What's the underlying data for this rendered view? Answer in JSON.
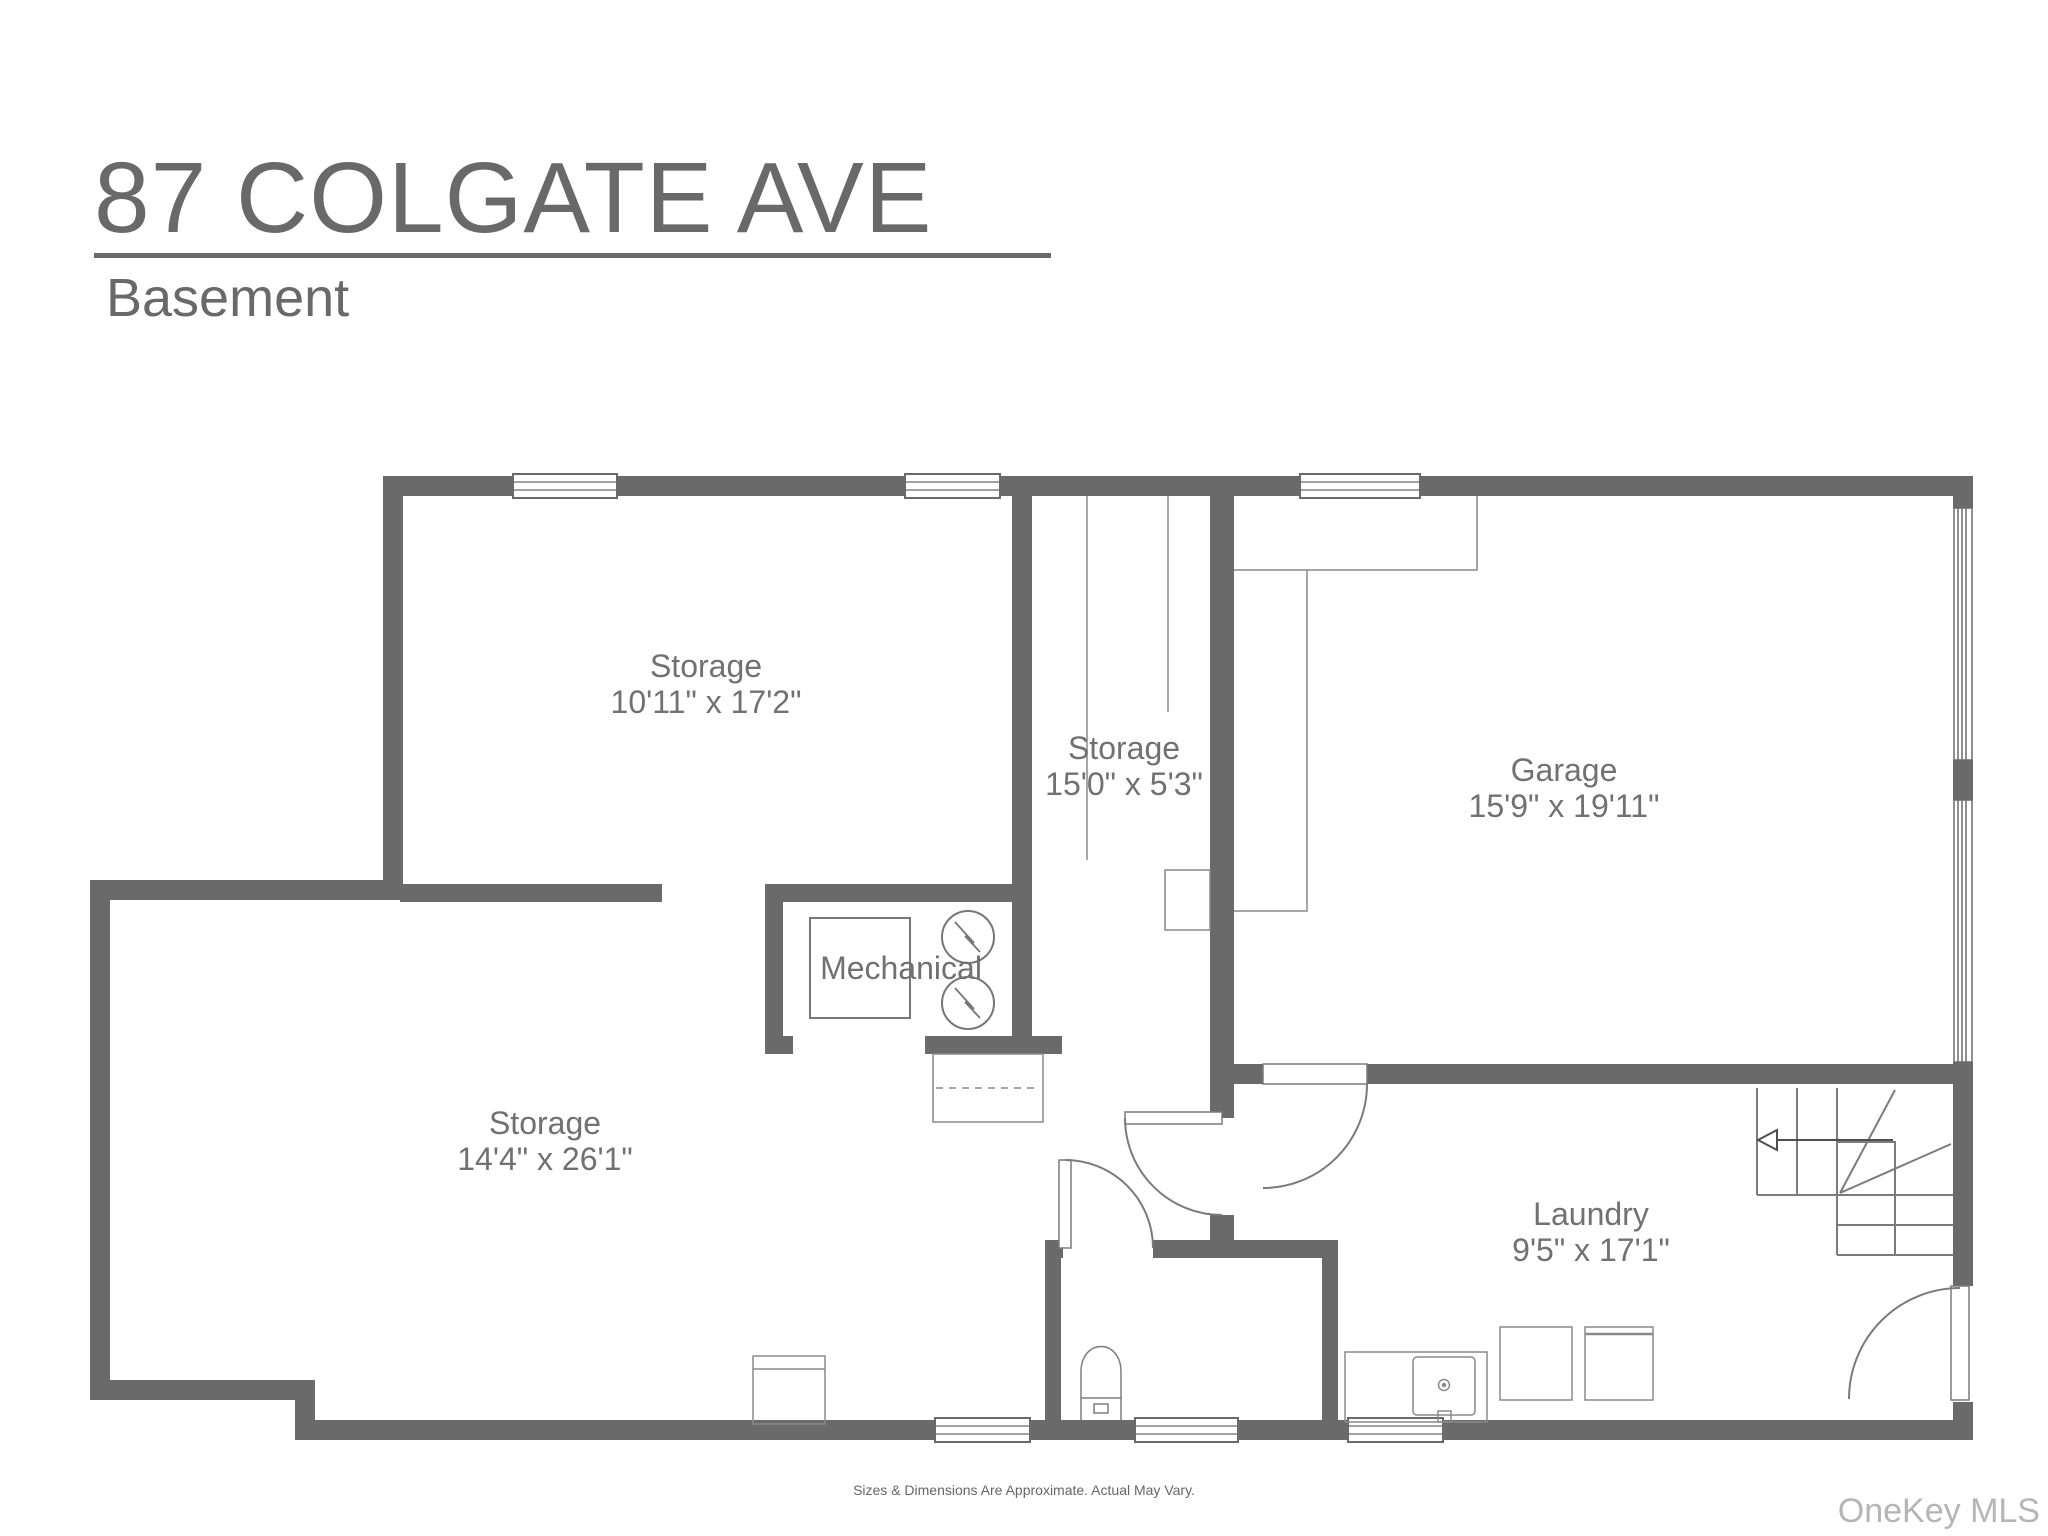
{
  "header": {
    "title": "87 COLGATE AVE",
    "subtitle": "Basement"
  },
  "rooms": [
    {
      "id": "storage-upper",
      "name": "Storage",
      "dims": "10'11\" x 17'2\""
    },
    {
      "id": "storage-middle",
      "name": "Storage",
      "dims": "15'0\" x 5'3\""
    },
    {
      "id": "garage",
      "name": "Garage",
      "dims": "15'9\" x 19'11\""
    },
    {
      "id": "mechanical",
      "name": "Mechanical",
      "dims": ""
    },
    {
      "id": "storage-lower",
      "name": "Storage",
      "dims": "14'4\" x 26'1\""
    },
    {
      "id": "laundry",
      "name": "Laundry",
      "dims": "9'5\" x 17'1\""
    }
  ],
  "footer": {
    "disclaimer": "Sizes & Dimensions Are Approximate. Actual May Vary."
  },
  "watermark": "OneKey MLS",
  "colors": {
    "wall": "#6a6a6a",
    "door_line": "#7b7b7b",
    "fixture_line": "#848484",
    "label_text": "#717171",
    "title_text": "#696969",
    "watermark_text": "#b5b5b5"
  }
}
